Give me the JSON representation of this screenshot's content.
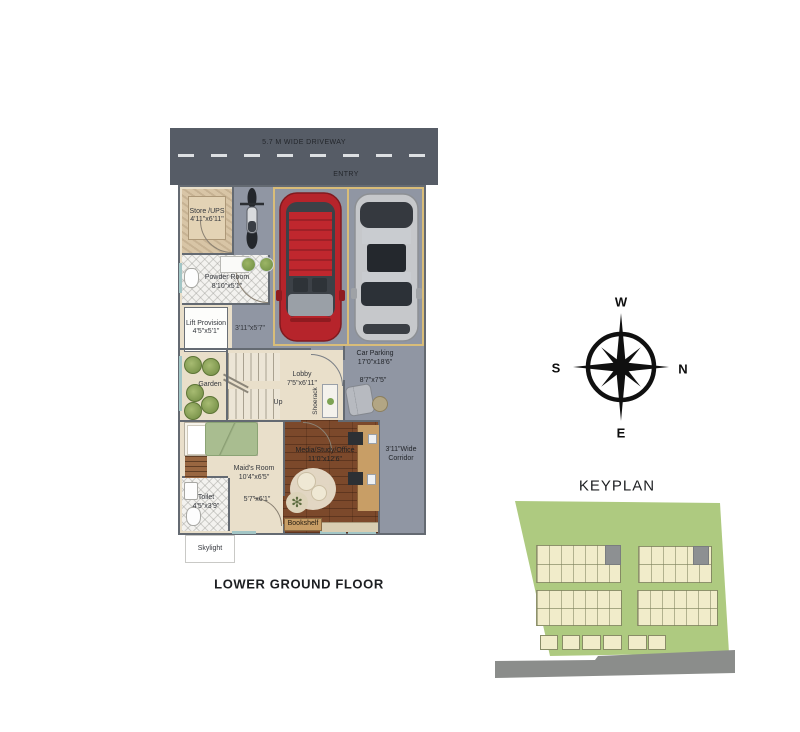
{
  "floor_plan": {
    "title": "LOWER GROUND  FLOOR",
    "driveway": {
      "label": "5.7 M WIDE DRIVEWAY",
      "entry": "ENTRY"
    },
    "rooms": {
      "store": {
        "name": "Store /UPS",
        "dim": "4'11\"x6'11\""
      },
      "powder_room": {
        "name": "Powder Room",
        "dim": "8'10\"x5'1\""
      },
      "lift": {
        "name": "Lift Provision",
        "dim": "4'5\"x5'1\""
      },
      "stair_passage": {
        "dim": "3'11\"x5'7\""
      },
      "garden": {
        "name": "Garden"
      },
      "lobby": {
        "name": "Lobby",
        "dim": "7'5\"x6'11\""
      },
      "stairs": {
        "direction": "Up"
      },
      "shoerack": {
        "name": "Shoerack"
      },
      "car_parking": {
        "name": "Car Parking",
        "dim": "17'0\"x18'6\""
      },
      "sitout": {
        "dim": "8'7\"x7'5\""
      },
      "media_room": {
        "name": "Media/Study/Office",
        "dim": "11'0\"x12'6\""
      },
      "corridor": {
        "line1": "3'11\"Wide",
        "line2": "Corridor"
      },
      "maids_room": {
        "name": "Maid's Room",
        "dim": "10'4\"x6'5\""
      },
      "maids_passage": {
        "dim": "5'7\"x6'1\""
      },
      "toilet": {
        "name": "Toilet",
        "dim": "4'5\"x3'9\""
      },
      "bookshelf": {
        "name": "Bookshelf"
      },
      "skylight": {
        "name": "Skylight"
      }
    }
  },
  "compass": {
    "west": "W",
    "south": "S",
    "north": "N",
    "east": "E"
  },
  "keyplan": {
    "title": "KEYPLAN"
  },
  "colors": {
    "driveway": "#565C66",
    "floor_gray": "#9096A3",
    "floor_beige": "#E9DFCA",
    "wall": "#646A72",
    "wood_floor": "#7C492B",
    "parking_border": "#D9BD79",
    "car_red": "#B6242B",
    "car_silver": "#C6C8CB",
    "window_teal": "#A3C6C6",
    "keyplan_green": "#AECA80",
    "plot_cream": "#F1ECCA",
    "road_gray": "#8B8D8B",
    "compass_black": "#101010"
  }
}
